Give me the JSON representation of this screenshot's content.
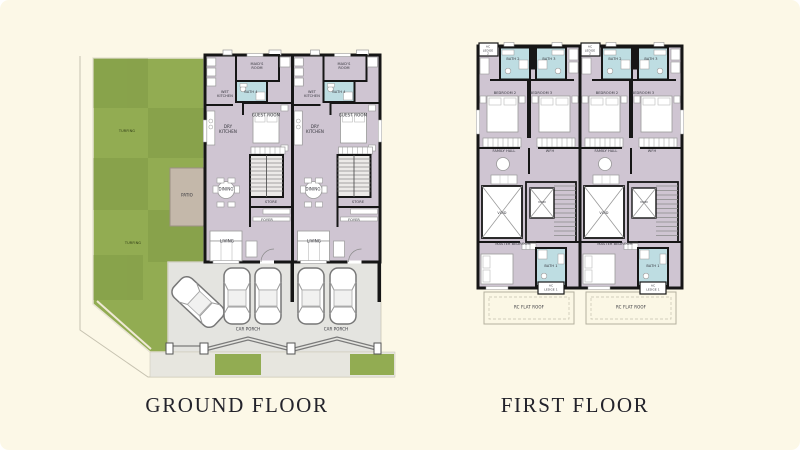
{
  "plans": [
    {
      "caption": "GROUND FLOOR"
    },
    {
      "caption": "FIRST FLOOR"
    }
  ],
  "labels": {
    "ground": {
      "turfing": "TURFING",
      "patio": "PATIO",
      "maids_room": "MAID'S ROOM",
      "wet_kitchen": "WET KITCHEN",
      "bath4": "BATH 4",
      "guest_room": "GUEST ROOM",
      "dry_kitchen": "DRY KITCHEN",
      "dining": "DINING",
      "store": "STORE",
      "foyer": "FOYER",
      "living": "LIVING",
      "car_porch": "CAR PORCH"
    },
    "first": {
      "ac_ledge2": "AC LEDGE 2",
      "bath2": "BATH 2",
      "bath3": "BATH 3",
      "bedroom2": "BEDROOM 2",
      "bedroom3": "BEDROOM 3",
      "family_hall": "FAMILY HALL",
      "wfh": "WFH",
      "void": "VOID",
      "master_bedroom": "MASTER BEDROOM",
      "bath1": "BATH 1",
      "ac_ledge1": "AC LEDGE 1",
      "rc_flat_roof": "RC FLAT ROOF"
    }
  },
  "colors": {
    "background": "#fcf8e7",
    "lawn": "#92ac52",
    "room_fill": "#cfc5d2",
    "bath_fill": "#bedde2",
    "wall": "#161616",
    "car_porch_floor": "#e4e4e0",
    "patio_fill": "#c4b8aa",
    "rc_roof_fill": "#fbf7e5",
    "caption_text": "#23232b"
  }
}
